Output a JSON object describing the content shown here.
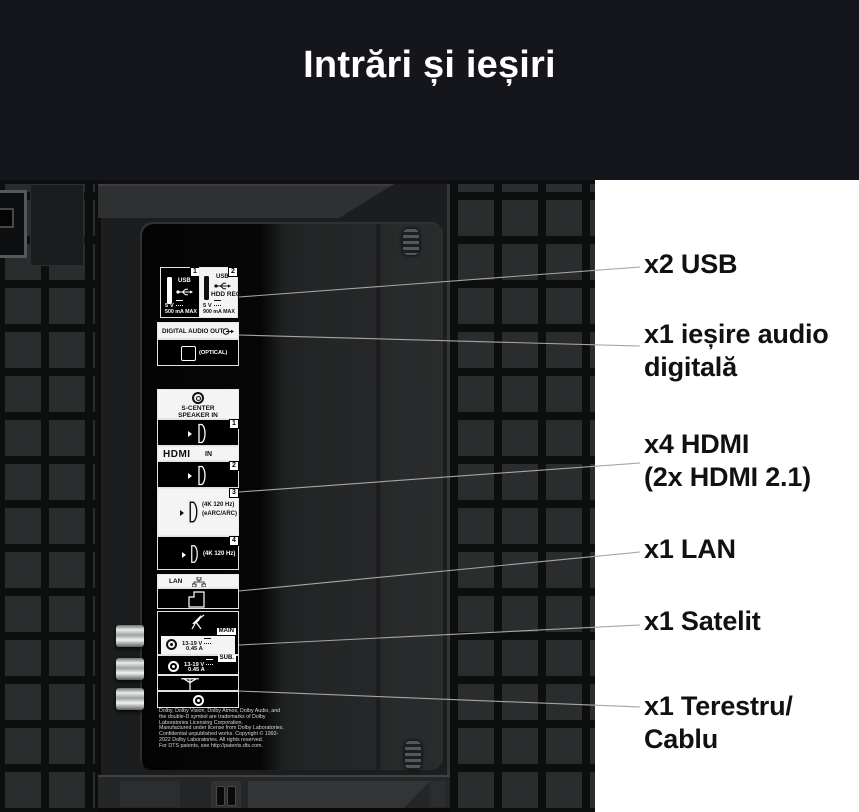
{
  "title": "Intrări și ieșiri",
  "annotations": [
    {
      "name": "usb",
      "text": "x2 USB",
      "top": 248,
      "line": [
        239,
        297,
        640,
        267
      ]
    },
    {
      "name": "audio-out",
      "text": "x1 ieșire audio\ndigitală",
      "top": 318,
      "line": [
        239,
        335,
        640,
        346
      ]
    },
    {
      "name": "hdmi",
      "text": "x4 HDMI\n(2x HDMI 2.1)",
      "top": 428,
      "line": [
        239,
        492,
        640,
        463
      ]
    },
    {
      "name": "lan",
      "text": "x1 LAN",
      "top": 533,
      "line": [
        239,
        591,
        640,
        552
      ]
    },
    {
      "name": "satellite",
      "text": "x1 Satelit",
      "top": 605,
      "line": [
        239,
        645,
        640,
        625
      ]
    },
    {
      "name": "terrestrial",
      "text": "x1 Terestru/\nCablu",
      "top": 690,
      "line": [
        239,
        691,
        640,
        707
      ]
    }
  ],
  "panel": {
    "usb1": {
      "badge": "1",
      "label": "USB",
      "volt": "5 V",
      "current": "500 mA MAX"
    },
    "usb2": {
      "badge": "2",
      "label": "USB",
      "hdd": "HDD REC",
      "volt": "5 V",
      "current": "900 mA MAX"
    },
    "digital_audio_out": "DIGITAL AUDIO OUT",
    "optical": "(OPTICAL)",
    "s_center": "S-CENTER\nSPEAKER IN",
    "hdmi_logo": "HDMI",
    "hdmi_in": "IN",
    "hdmi_badges": [
      "1",
      "2",
      "3",
      "4"
    ],
    "hdmi3_line1": "(4K 120 Hz)",
    "hdmi3_line2": "(eARC/ARC)",
    "hdmi4_line1": "(4K 120 Hz)",
    "lan": "LAN",
    "sat_main_tag": "MAIN",
    "sat_main_v": "13-19 V",
    "sat_main_a": "0.45 A",
    "sat_sub_tag": "SUB.",
    "sat_sub_v": "13-19 V",
    "sat_sub_a": "0.45 A",
    "legal": "Dolby, Dolby Vision, Dolby Atmos, Dolby Audio, and\nthe double-D symbol are trademarks of Dolby\nLaboratories Licensing Corporation.\nManufactured under license from Dolby Laboratories.\nConfidential unpublished works. Copyright © 1992-\n2022 Dolby Laboratories. All rights reserved.\nFor DTS patents, see http://patents.dts.com."
  },
  "colors": {
    "title_band": "#15151c",
    "label_text": "#111111",
    "leader_line": "#a6a6a6",
    "panel_border": "#e2e2e2"
  }
}
